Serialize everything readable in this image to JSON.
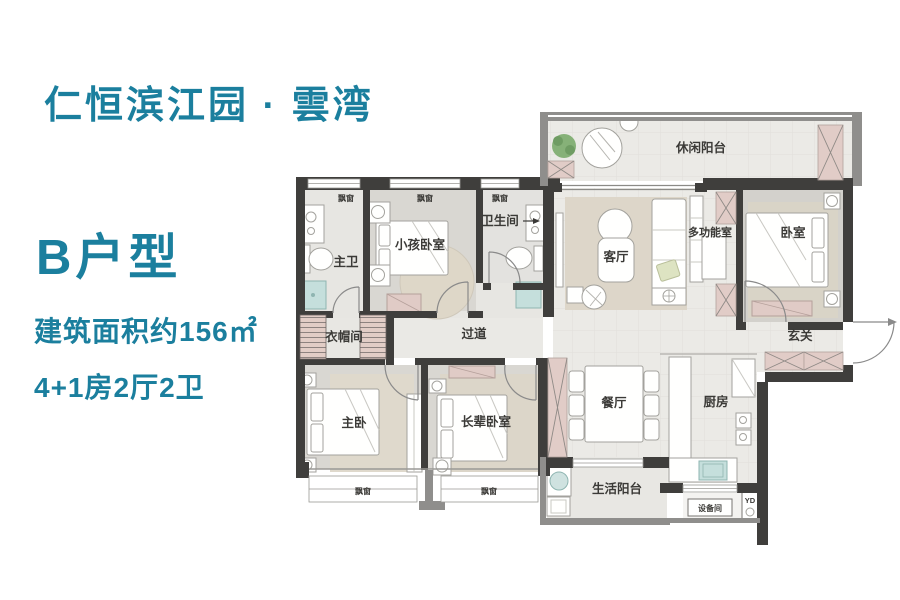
{
  "info_panel": {
    "title": "仁恒滨江园 · 雲湾",
    "unit_label": "B户型",
    "area_text": "建筑面积约156㎡",
    "layout_text": "4+1房2厅2卫",
    "accent_color": "#1b7f9e"
  },
  "floor_plan": {
    "bay_window_label": "飘窗",
    "yd_label": "YD",
    "rooms": [
      {
        "id": "leisure-balcony",
        "label": "休闲阳台"
      },
      {
        "id": "master-bath",
        "label": "主卫"
      },
      {
        "id": "kids-bedroom",
        "label": "小孩卧室"
      },
      {
        "id": "bathroom",
        "label": "卫生间"
      },
      {
        "id": "living-room",
        "label": "客厅"
      },
      {
        "id": "multi-function-room",
        "label": "多功能室"
      },
      {
        "id": "bedroom",
        "label": "卧室"
      },
      {
        "id": "cloakroom",
        "label": "衣帽间"
      },
      {
        "id": "hallway",
        "label": "过道"
      },
      {
        "id": "foyer",
        "label": "玄关"
      },
      {
        "id": "master-bedroom",
        "label": "主卧"
      },
      {
        "id": "elders-bedroom",
        "label": "长辈卧室"
      },
      {
        "id": "dining-room",
        "label": "餐厅"
      },
      {
        "id": "kitchen",
        "label": "厨房"
      },
      {
        "id": "service-balcony",
        "label": "生活阳台"
      },
      {
        "id": "equipment-room",
        "label": "设备间"
      }
    ],
    "colors": {
      "wall": "#3f3e3c",
      "wall_exterior": "#8f8e8c",
      "column_pink": "#e1ccc7",
      "floor_tile": "#ebeae6",
      "floor_room": "#d9d7d2",
      "rug": "#ddd6c9",
      "fixture_teal": "#c5dfdc"
    }
  }
}
